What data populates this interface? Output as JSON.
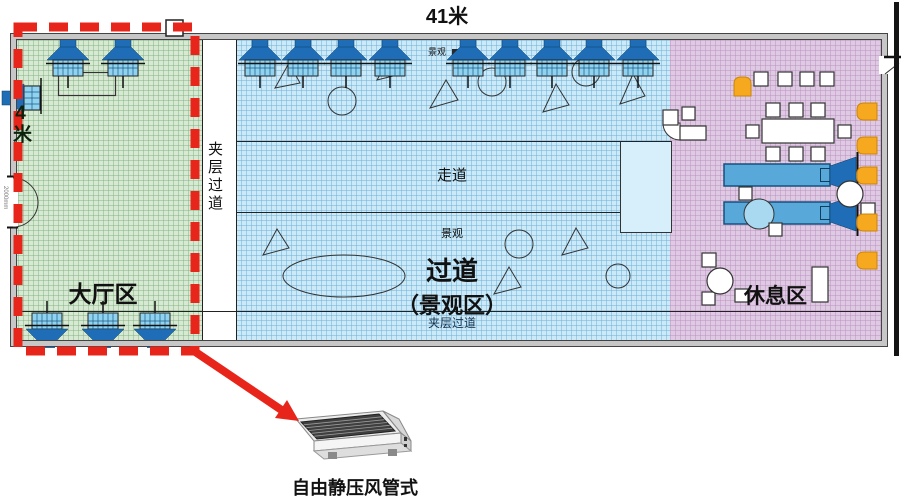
{
  "dimensions": {
    "top": "41米",
    "left": "4米",
    "door": "2000mm"
  },
  "zones": {
    "lobby": {
      "label": "大厅区",
      "color": "#d7e9d3"
    },
    "corridor": {
      "line1": "过道",
      "line2": "（景观区）",
      "color": "#cbe9f7"
    },
    "rest": {
      "label": "休息区",
      "color": "#decae2"
    }
  },
  "corridors": {
    "mezzanine_left": "夹层过道",
    "mezzanine_bottom": "夹层过道",
    "walkway": "走道",
    "scenic_mid": "景观",
    "scenic_top": "景观"
  },
  "ac_unit": {
    "caption": "自由静压风管式"
  },
  "colors": {
    "highlight_red": "#E8251A",
    "fan_blue": "#1E6DB6",
    "fan_grid_blue": "#8FD3F0",
    "duct_blue": "#58A9DA",
    "chair_orange": "#F6A81E",
    "wall_gray": "#c7c7c7"
  },
  "equipment": {
    "ceiling_fans_top_x": [
      68,
      123,
      260,
      303,
      346,
      390,
      468,
      510,
      552,
      594,
      638
    ],
    "floor_fans_bottom_x": [
      47,
      103,
      155
    ],
    "duct_units_y": [
      164,
      202
    ]
  },
  "furniture": {
    "white_rects": [
      [
        754,
        72,
        14,
        14
      ],
      [
        778,
        72,
        14,
        14
      ],
      [
        800,
        72,
        14,
        14
      ],
      [
        820,
        72,
        14,
        14
      ],
      [
        766,
        103,
        14,
        14
      ],
      [
        789,
        103,
        14,
        14
      ],
      [
        811,
        103,
        14,
        14
      ],
      [
        762,
        119,
        72,
        24
      ],
      [
        746,
        125,
        13,
        13
      ],
      [
        838,
        125,
        13,
        13
      ],
      [
        766,
        147,
        14,
        14
      ],
      [
        789,
        147,
        14,
        14
      ],
      [
        811,
        147,
        14,
        14
      ],
      [
        739,
        187,
        13,
        13
      ],
      [
        769,
        223,
        13,
        13
      ],
      [
        861,
        203,
        14,
        14
      ],
      [
        702,
        253,
        14,
        14
      ],
      [
        702,
        292,
        13,
        13
      ],
      [
        735,
        289,
        13,
        13
      ],
      [
        812,
        267,
        16,
        35
      ],
      [
        680,
        126,
        26,
        14
      ],
      [
        663,
        110,
        15,
        15
      ],
      [
        682,
        107,
        13,
        13
      ]
    ],
    "white_circles": [
      [
        850,
        194,
        13
      ],
      [
        720,
        281,
        13
      ]
    ],
    "orange_chairs": [
      {
        "x": 734,
        "y": 77,
        "w": 17,
        "h": 19,
        "side": "top"
      },
      {
        "x": 857,
        "y": 103,
        "w": 20,
        "h": 17,
        "side": "left"
      },
      {
        "x": 857,
        "y": 137,
        "w": 20,
        "h": 17,
        "side": "left"
      },
      {
        "x": 857,
        "y": 167,
        "w": 20,
        "h": 17,
        "side": "left"
      },
      {
        "x": 857,
        "y": 214,
        "w": 20,
        "h": 17,
        "side": "left"
      },
      {
        "x": 857,
        "y": 252,
        "w": 20,
        "h": 17,
        "side": "left"
      }
    ]
  },
  "landscape_shapes": {
    "triangles": [
      [
        275,
        88,
        300,
        83,
        289,
        63
      ],
      [
        377,
        80,
        401,
        74,
        390,
        57
      ],
      [
        430,
        108,
        458,
        100,
        446,
        80
      ],
      [
        543,
        112,
        569,
        105,
        556,
        84
      ],
      [
        620,
        104,
        645,
        96,
        633,
        74
      ],
      [
        263,
        255,
        289,
        248,
        277,
        229
      ],
      [
        494,
        294,
        521,
        287,
        509,
        267
      ],
      [
        562,
        255,
        588,
        248,
        576,
        228
      ]
    ],
    "circles": [
      [
        342,
        101,
        14
      ],
      [
        492,
        82,
        14
      ],
      [
        586,
        72,
        14
      ],
      [
        519,
        244,
        14
      ],
      [
        618,
        276,
        12
      ]
    ],
    "ellipse": [
      344,
      276,
      61,
      21
    ]
  },
  "highlight": {
    "dashed_box": [
      18,
      27,
      177,
      324
    ],
    "arrow_from": [
      194,
      351
    ],
    "arrow_to": [
      283,
      411
    ]
  }
}
